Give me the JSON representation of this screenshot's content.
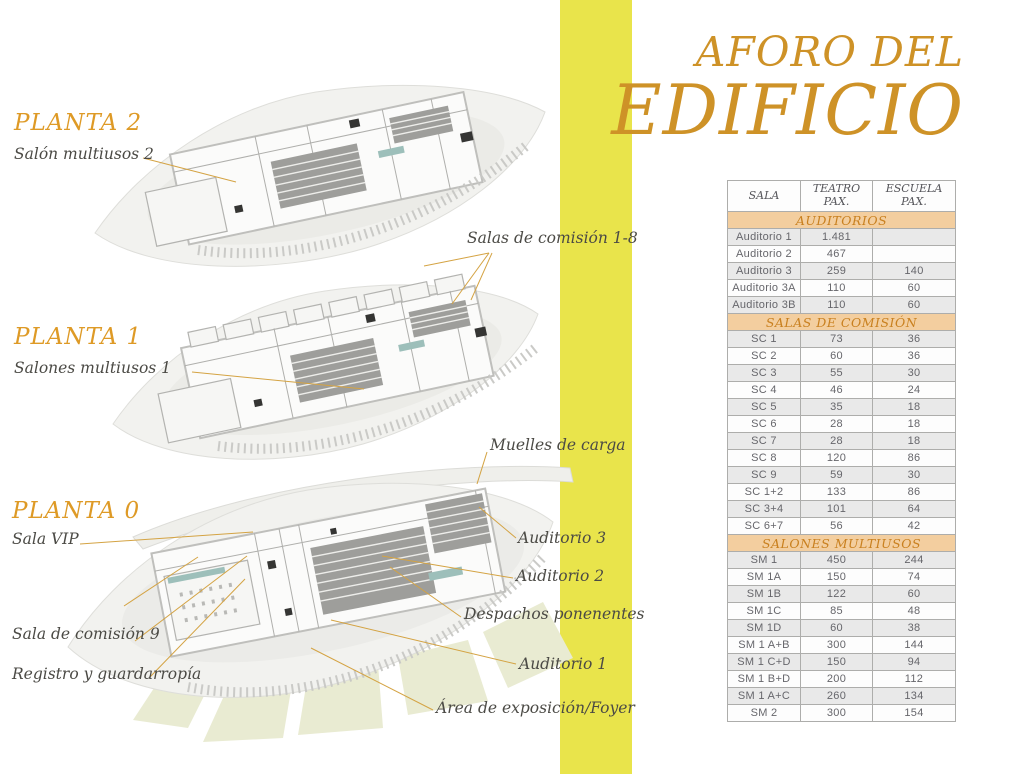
{
  "title": {
    "line1": "AFORO DEL",
    "line2": "EDIFICIO"
  },
  "accent_colors": {
    "title_orange": "#CE9227",
    "heading_orange": "#DE9A26",
    "leader_orange": "#D4A343",
    "yellow_band": "#E9E44B",
    "table_section_bg": "#F3CE9F",
    "table_section_text": "#C9801F"
  },
  "floors": {
    "planta2": {
      "heading": "PLANTA 2",
      "labels": {
        "salon_multiusos_2": "Salón multiusos 2",
        "salas_comision_1_8": "Salas de comisión 1-8"
      }
    },
    "planta1": {
      "heading": "PLANTA 1",
      "labels": {
        "salones_multiusos_1": "Salones multiusos 1"
      }
    },
    "planta0": {
      "heading": "PLANTA 0",
      "labels": {
        "sala_vip": "Sala VIP",
        "muelles_de_carga": "Muelles de carga",
        "auditorio_3": "Auditorio 3",
        "auditorio_2": "Auditorio 2",
        "despachos_ponenentes": "Despachos ponenentes",
        "sala_de_comision_9": "Sala de comisión 9",
        "auditorio_1": "Auditorio 1",
        "registro_y_guardarropia": "Registro y guardarropía",
        "area_exposicion_foyer": "Área de exposición/Foyer"
      }
    }
  },
  "table": {
    "columns": [
      {
        "line1": "SALA",
        "line2": ""
      },
      {
        "line1": "TEATRO",
        "line2": "PAX."
      },
      {
        "line1": "ESCUELA",
        "line2": "PAX."
      }
    ],
    "sections": [
      {
        "title": "AUDITORIOS",
        "rows": [
          [
            "Auditorio 1",
            "1.481",
            ""
          ],
          [
            "Auditorio 2",
            "467",
            ""
          ],
          [
            "Auditorio 3",
            "259",
            "140"
          ],
          [
            "Auditorio 3A",
            "110",
            "60"
          ],
          [
            "Auditorio 3B",
            "110",
            "60"
          ]
        ]
      },
      {
        "title": "SALAS DE COMISIÓN",
        "rows": [
          [
            "SC 1",
            "73",
            "36"
          ],
          [
            "SC 2",
            "60",
            "36"
          ],
          [
            "SC 3",
            "55",
            "30"
          ],
          [
            "SC 4",
            "46",
            "24"
          ],
          [
            "SC 5",
            "35",
            "18"
          ],
          [
            "SC 6",
            "28",
            "18"
          ],
          [
            "SC 7",
            "28",
            "18"
          ],
          [
            "SC 8",
            "120",
            "86"
          ],
          [
            "SC 9",
            "59",
            "30"
          ],
          [
            "SC 1+2",
            "133",
            "86"
          ],
          [
            "SC 3+4",
            "101",
            "64"
          ],
          [
            "SC 6+7",
            "56",
            "42"
          ]
        ]
      },
      {
        "title": "SALONES MULTIUSOS",
        "rows": [
          [
            "SM 1",
            "450",
            "244"
          ],
          [
            "SM 1A",
            "150",
            "74"
          ],
          [
            "SM 1B",
            "122",
            "60"
          ],
          [
            "SM 1C",
            "85",
            "48"
          ],
          [
            "SM 1D",
            "60",
            "38"
          ],
          [
            "SM 1 A+B",
            "300",
            "144"
          ],
          [
            "SM 1 C+D",
            "150",
            "94"
          ],
          [
            "SM 1 B+D",
            "200",
            "112"
          ],
          [
            "SM 1 A+C",
            "260",
            "134"
          ],
          [
            "SM 2",
            "300",
            "154"
          ]
        ]
      }
    ]
  }
}
